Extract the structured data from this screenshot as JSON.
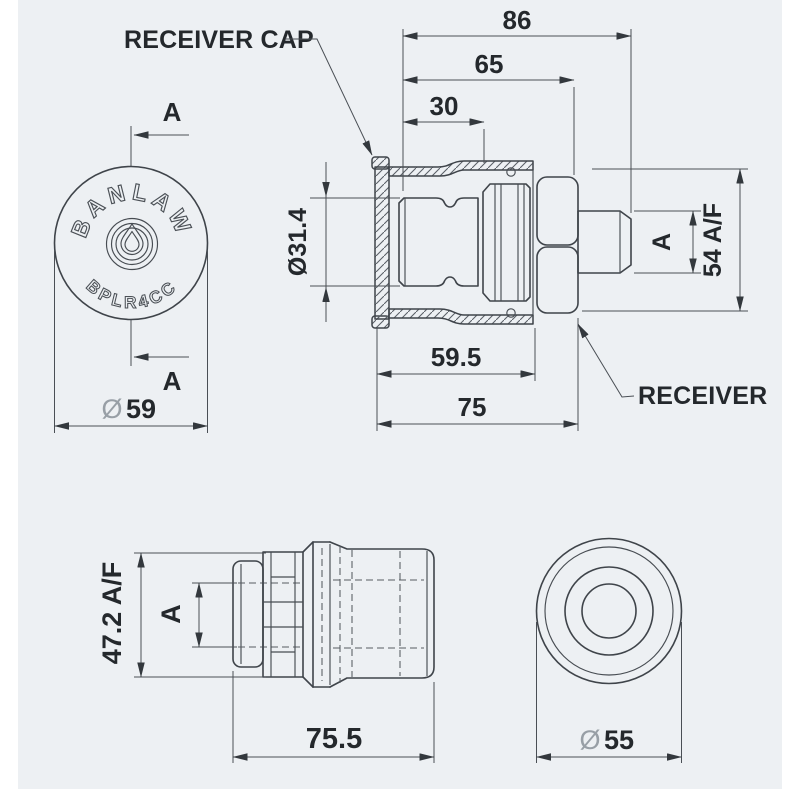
{
  "title": "Banlaw BPLR4CC receiver and receiver cap technical drawing",
  "colors": {
    "background": "#edf0f3",
    "page_margin": "#ffffff",
    "line": "#3f444a",
    "dimension_line": "#4a4f55",
    "text": "#24282c",
    "diameter_symbol": "#989fa6"
  },
  "labels": {
    "receiver_cap": "RECEIVER CAP",
    "receiver": "RECEIVER"
  },
  "front_view": {
    "brand": "BANLAW",
    "model": "BPLR4CC",
    "section_letter_top": "A",
    "section_letter_bottom": "A",
    "dia_symbol": "Ø",
    "dia_value": "59"
  },
  "side_view": {
    "dim_overall": "86",
    "dim_receiver": "65",
    "dim_nose": "30",
    "dim_plug_dia": "Ø31.4",
    "dim_hex": "54 A/F",
    "dim_thread": "A",
    "dim_cap": "59.5",
    "dim_cap_hex": "75"
  },
  "nozzle_view": {
    "dim_hex": "47.2 A/F",
    "dim_thread": "A",
    "dim_overall": "75.5"
  },
  "end_view": {
    "dia_symbol": "Ø",
    "dia_value": "55"
  }
}
